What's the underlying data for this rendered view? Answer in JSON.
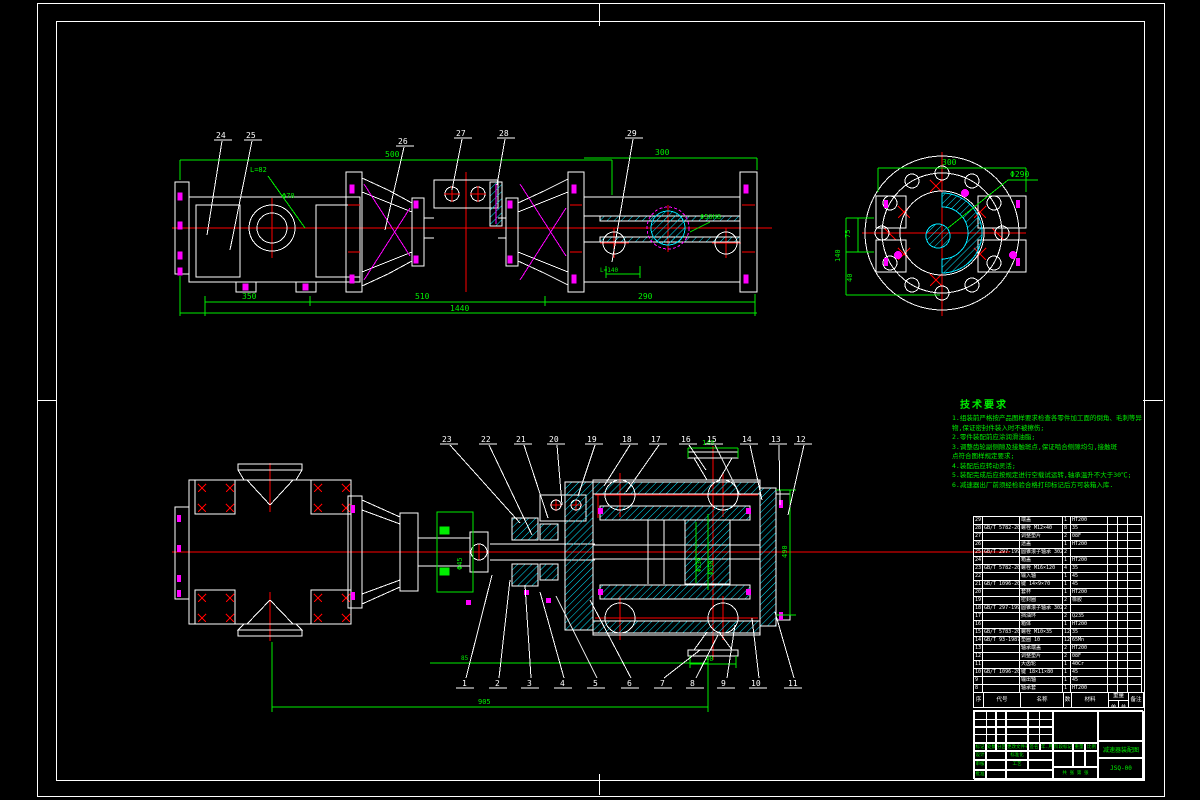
{
  "colors": {
    "line": "#ffffff",
    "dim": "#00ee00",
    "hatch": "#00e5ff",
    "center": "#ff0000",
    "bolt": "#ff00ff"
  },
  "top_view": {
    "balloons": [
      "24",
      "25",
      "26",
      "27",
      "28",
      "29"
    ],
    "dims": {
      "d500": "500",
      "d300": "300",
      "d350": "350",
      "d510": "510",
      "d290": "290",
      "d1440": "1440",
      "l82": "L=82",
      "phi70": "Φ70",
      "phi50": "Φ50H8",
      "l140": "L=140"
    }
  },
  "flange_view": {
    "phi290": "Φ290",
    "d300": "300",
    "d75": "75",
    "d140": "140",
    "d40": "40"
  },
  "bottom_view": {
    "balloons_top": [
      "23",
      "22",
      "21",
      "20",
      "19",
      "18",
      "17",
      "16",
      "15",
      "14",
      "13",
      "12"
    ],
    "balloons_bottom": [
      "1",
      "2",
      "3",
      "4",
      "5",
      "6",
      "7",
      "8",
      "9",
      "10",
      "11"
    ],
    "dims": {
      "d140": "140",
      "d40": "40",
      "d490": "490",
      "d85": "85",
      "d905": "905",
      "phi45": "Φ45",
      "phi230": "Φ230",
      "phi250": "Φ250"
    }
  },
  "notes": {
    "title": "技术要求",
    "lines": [
      "1.组装前严格按产品图样要求检查各零件加工面的倒角、毛刺等异",
      "物,保证密封件装入时不被擦伤;",
      "2.零件装配前应涂润滑油脂;",
      "3.调整齿轮副侧隙及接触斑点,保证啮合侧隙均匀,接触斑",
      "点符合图样规定要求;",
      "4.装配后应转动灵活;",
      "5.装配完成后应按规定进行空载试运转,轴承温升不大于30℃;",
      "6.减速器出厂前须经检验合格打印标记后方可装箱入库."
    ]
  },
  "parts_table": {
    "headers": [
      "序号",
      "代号",
      "名称",
      "数量",
      "材料",
      "单件",
      "总计",
      "备注"
    ],
    "weight_label": "重量",
    "rows": [
      [
        "29",
        "",
        "端盖",
        "1",
        "HT200",
        "",
        "",
        ""
      ],
      [
        "28",
        "GB/T 5782-2000",
        "螺栓 M12×40",
        "8",
        "35",
        "",
        "",
        ""
      ],
      [
        "27",
        "",
        "调整垫片",
        "2",
        "08F",
        "",
        "",
        ""
      ],
      [
        "26",
        "",
        "透盖",
        "1",
        "HT200",
        "",
        "",
        ""
      ],
      [
        "25",
        "GB/T 297-1994",
        "圆锥滚子轴承 30212",
        "2",
        "",
        "",
        "",
        ""
      ],
      [
        "24",
        "",
        "箱盖",
        "1",
        "HT200",
        "",
        "",
        ""
      ],
      [
        "23",
        "GB/T 5782-2000",
        "螺栓 M16×120",
        "4",
        "35",
        "",
        "",
        ""
      ],
      [
        "22",
        "",
        "输入轴",
        "1",
        "45",
        "",
        "",
        ""
      ],
      [
        "21",
        "GB/T 1096-2003",
        "键 14×9×70",
        "1",
        "45",
        "",
        "",
        ""
      ],
      [
        "20",
        "",
        "套杯",
        "1",
        "HT200",
        "",
        "",
        ""
      ],
      [
        "19",
        "",
        "密封圈",
        "2",
        "橡胶",
        "",
        "",
        ""
      ],
      [
        "18",
        "GB/T 297-1994",
        "圆锥滚子轴承 30215",
        "2",
        "",
        "",
        "",
        ""
      ],
      [
        "17",
        "",
        "挡油环",
        "2",
        "Q235",
        "",
        "",
        ""
      ],
      [
        "16",
        "",
        "箱体",
        "1",
        "HT200",
        "",
        "",
        ""
      ],
      [
        "15",
        "GB/T 5783-2000",
        "螺栓 M10×35",
        "12",
        "35",
        "",
        "",
        ""
      ],
      [
        "14",
        "GB/T 93-1987",
        "垫圈 10",
        "12",
        "65Mn",
        "",
        "",
        ""
      ],
      [
        "13",
        "",
        "轴承端盖",
        "2",
        "HT200",
        "",
        "",
        ""
      ],
      [
        "12",
        "",
        "调整垫片",
        "2",
        "08F",
        "",
        "",
        ""
      ],
      [
        "11",
        "",
        "大齿轮",
        "1",
        "40Cr",
        "",
        "",
        ""
      ],
      [
        "10",
        "GB/T 1096-2003",
        "键 18×11×80",
        "1",
        "45",
        "",
        "",
        ""
      ],
      [
        "9",
        "",
        "输出轴",
        "1",
        "45",
        "",
        "",
        ""
      ],
      [
        "8",
        "",
        "轴承套",
        "1",
        "HT200",
        "",
        "",
        ""
      ]
    ]
  },
  "title_block": {
    "mark": "标记",
    "count": "处数",
    "zone": "分区",
    "file_no": "更改文件号",
    "sign": "签名",
    "date": "年.月.日",
    "design": "设计",
    "standard": "标准化",
    "stage": "阶段标记",
    "weight": "重量",
    "scale": "比例",
    "audit": "审核",
    "craft": "工艺",
    "approve": "批准",
    "sheets": "共 张  第 张",
    "title": "减速器装配图",
    "drawing_no": "JSQ-00"
  }
}
